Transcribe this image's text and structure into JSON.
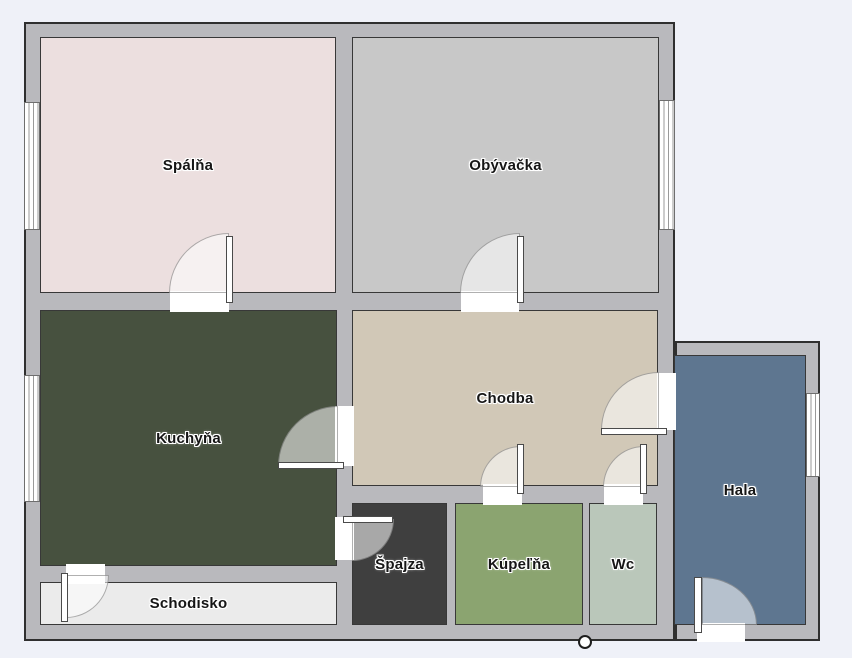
{
  "floorplan": {
    "background_color": "#eff1f8",
    "wall_color": "#b9b9bd",
    "outline_color": "#2f2f2f",
    "rooms": [
      {
        "label": "Spálňa",
        "color": "#ecdfdf"
      },
      {
        "label": "Obývačka",
        "color": "#c8c8c8"
      },
      {
        "label": "Kuchyňa",
        "color": "#47513f"
      },
      {
        "label": "Chodba",
        "color": "#d1c8b7"
      },
      {
        "label": "Hala",
        "color": "#5e7690"
      },
      {
        "label": "Špajza",
        "color": "#3f3f3f"
      },
      {
        "label": "Kúpeľňa",
        "color": "#8ba470"
      },
      {
        "label": "Wc",
        "color": "#bac7ba"
      },
      {
        "label": "Schodisko",
        "color": "#ebebeb"
      }
    ]
  }
}
